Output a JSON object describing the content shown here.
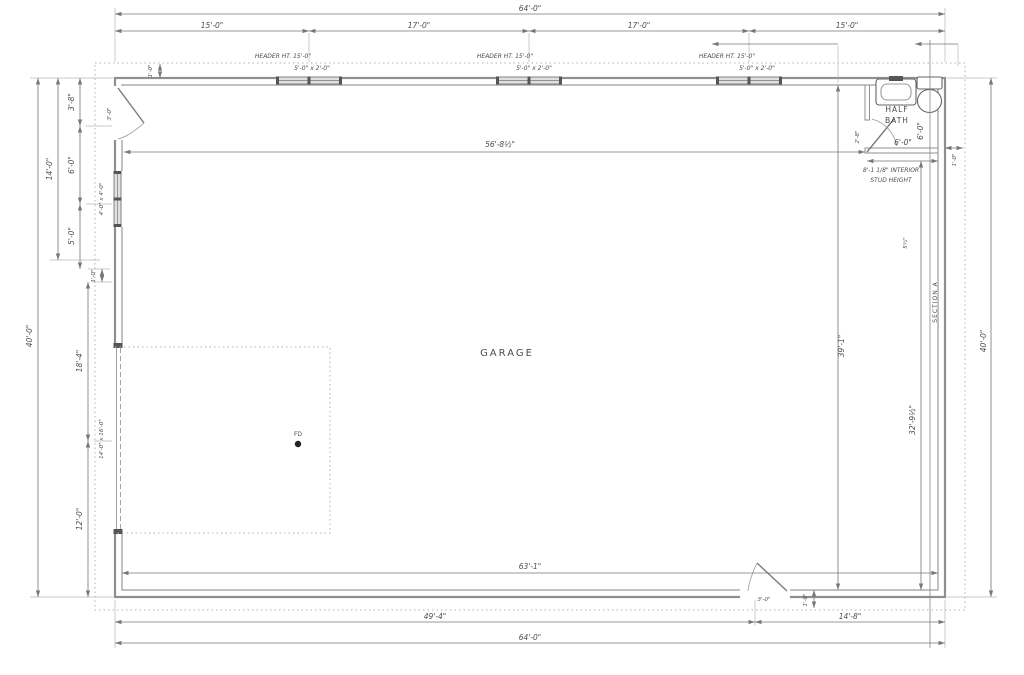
{
  "room": {
    "label": "GARAGE",
    "floor_drain": "FD"
  },
  "half_bath": {
    "label_line1": "HALF",
    "label_line2": "BATH",
    "width": "6'-0\"",
    "depth": "6'-0\"",
    "door_width": "2'-8\"",
    "stud_note_line1": "8'-1 1/8\" INTERIOR",
    "stud_note_line2": "STUD HEIGHT"
  },
  "section": {
    "label": "SECTION A"
  },
  "openings": {
    "entry_door_left": "3'-0\"",
    "entry_door_rear": "3'-0\"",
    "window_left": "4'-0\" x 4'-0\"",
    "overhead_door": "14'-0\" x 16'-0\""
  },
  "dims": {
    "top_overall": "64'-0\"",
    "top_segments": [
      "15'-0\"",
      "17'-0\"",
      "17'-0\"",
      "15'-0\""
    ],
    "header_note": "HEADER HT. 15'-0\"",
    "window_size": "5'-0\" x 2'-0\"",
    "offset_1ft": "1'-0\"",
    "left_overall": "40'-0\"",
    "left_upper": "14'-0\"",
    "left_segments": [
      "3'-8\"",
      "6'-0\"",
      "5'-0\""
    ],
    "left_mid": "18'-4\"",
    "left_lower": "12'-0\"",
    "interior_width": "56'-8½\"",
    "interior_height": "39'-1\"",
    "garage_depth": "32'-9½\"",
    "right_overall": "40'-0\"",
    "wall_thickness": "5½\"",
    "bottom_interior": "63'-1\"",
    "bottom_left": "49'-4\"",
    "bottom_right": "14'-8\"",
    "bottom_overall": "64'-0\""
  }
}
